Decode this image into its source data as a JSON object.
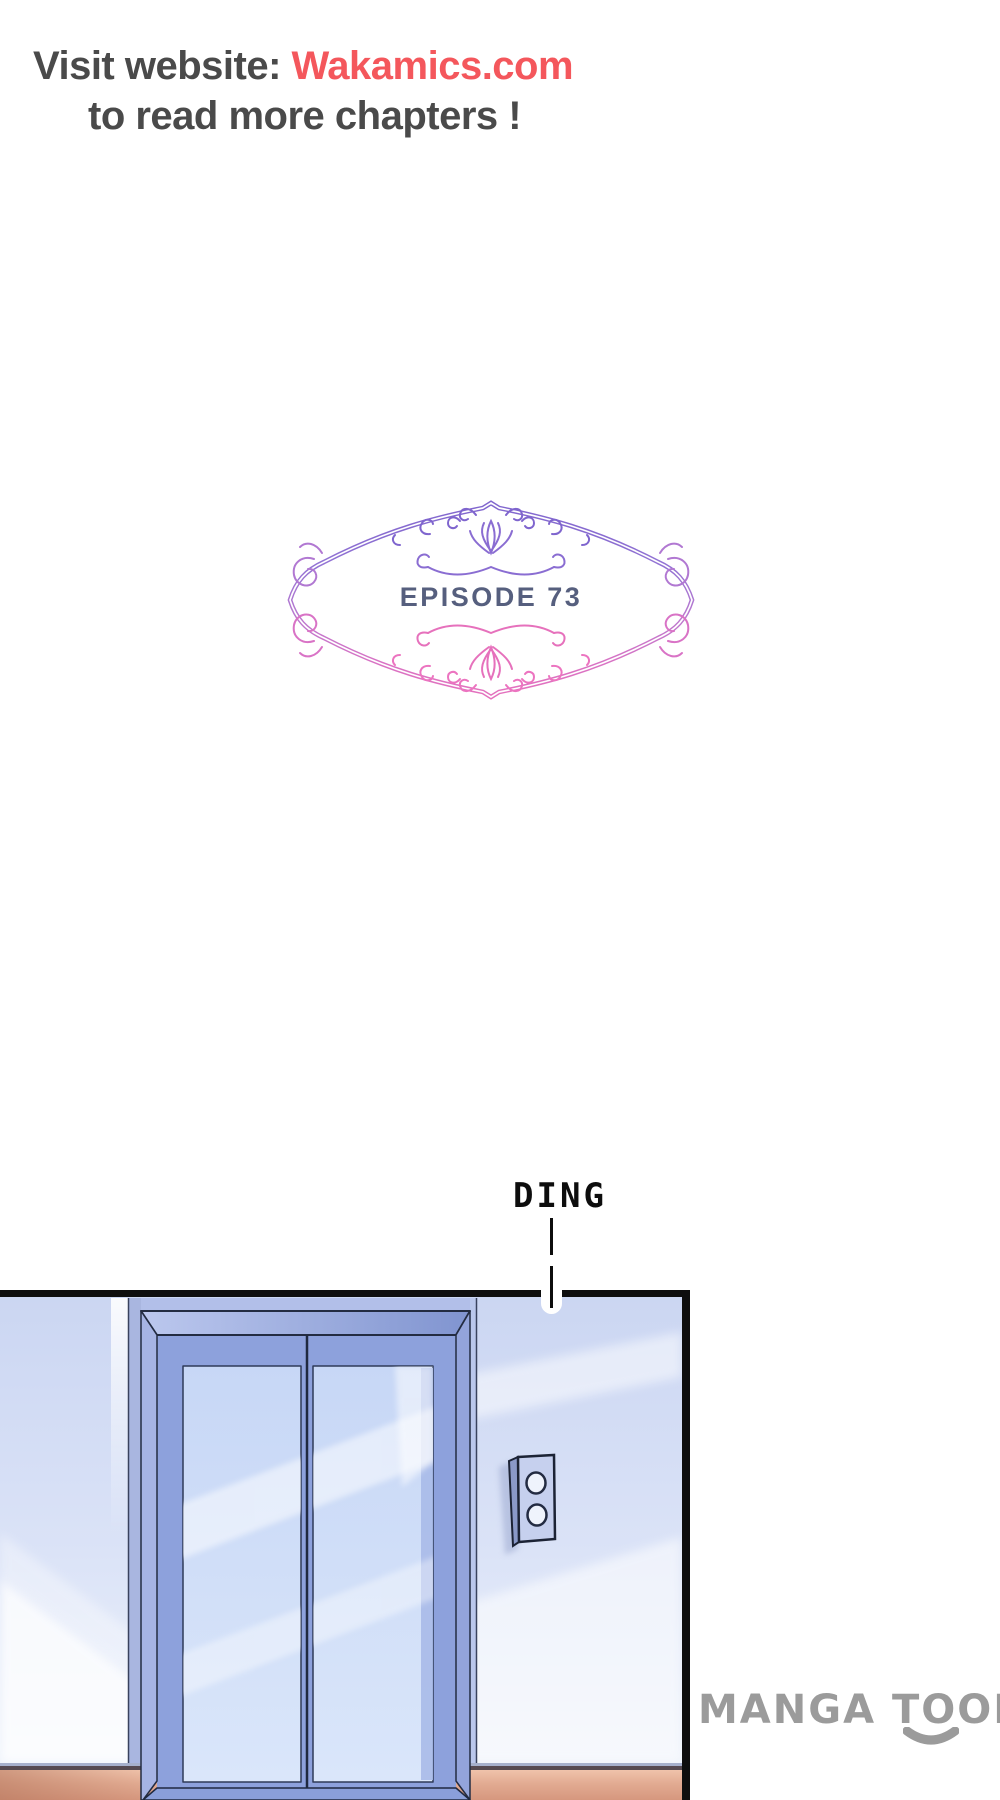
{
  "page": {
    "background": "#ffffff",
    "width": 1000,
    "height": 1800
  },
  "promo": {
    "line1_prefix": "Visit website: ",
    "line1_link": "Wakamics.com",
    "line2": "to read more chapters !",
    "text_color": "#4a4a4a",
    "link_color": "#f4575c"
  },
  "episode_badge": {
    "label": "EPISODE 73",
    "text_color": "#565f7e",
    "frame_gradient_top": "#7b63cc",
    "frame_gradient_bottom": "#ea70ba"
  },
  "sfx": {
    "label": "DING",
    "color": "#0d0d0d"
  },
  "comic_panel": {
    "border_color": "#0e0e0e",
    "wall_color": "#ccd7f3",
    "elevator_frame_color": "#8da1dc",
    "door_glass_color": "#cfdcf8",
    "floor_color": "#dfa58c",
    "call_panel_color": "#c6d0ee",
    "call_button_count": 2
  },
  "watermark": {
    "label": "MANGA TOON",
    "color": "#9b9b9b"
  }
}
